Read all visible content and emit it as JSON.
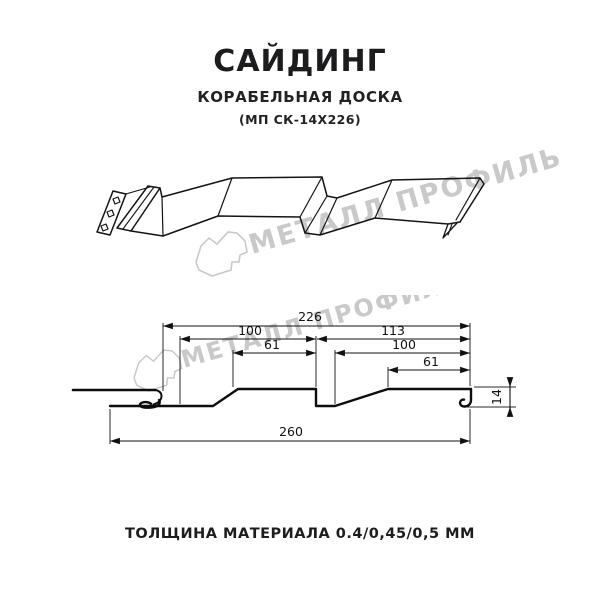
{
  "header": {
    "title": "САЙДИНГ",
    "subtitle": "КОРАБЕЛЬНАЯ ДОСКА",
    "model": "(МП СК-14Х226)"
  },
  "watermark": {
    "text": "МЕТАЛЛ ПРОФИЛЬ",
    "logo": "metall-profil-logo",
    "color": "#c9c9c9"
  },
  "section": {
    "d226": "226",
    "d100_left": "100",
    "d113": "113",
    "d61_left": "61",
    "d100_right": "100",
    "d61_right": "61",
    "d14": "14",
    "d260": "260"
  },
  "footer": {
    "thickness": "ТОЛЩИНА МАТЕРИАЛА 0.4/0,45/0,5 ММ"
  },
  "colors": {
    "line": "#141414",
    "text": "#1d1d1f",
    "watermark": "#c9c9c9",
    "background": "#ffffff"
  }
}
